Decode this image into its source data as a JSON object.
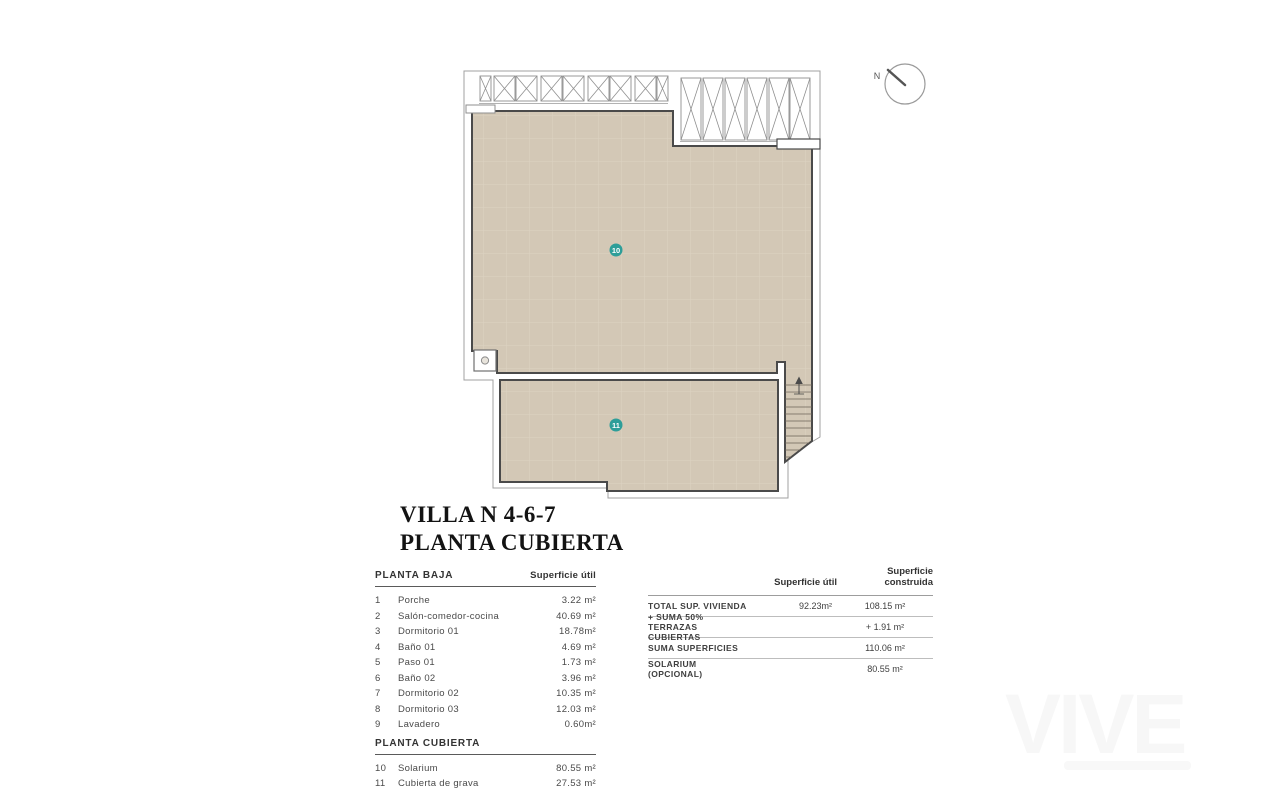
{
  "title": {
    "line1": "VILLA N 4-6-7",
    "line2": "PLANTA CUBIERTA"
  },
  "compass": {
    "label": "N"
  },
  "plan": {
    "room_10_label": "10",
    "room_11_label": "11",
    "floor_fill": "#d3c8b6",
    "accent_teal": "#2d9e99"
  },
  "areas": {
    "section1_title": "PLANTA BAJA",
    "column_title": "Superficie útil",
    "rows": [
      {
        "num": "1",
        "name": "Porche",
        "value": "3.22 m²"
      },
      {
        "num": "2",
        "name": "Salón-comedor-cocina",
        "value": "40.69 m²"
      },
      {
        "num": "3",
        "name": "Dormitorio 01",
        "value": "18.78m²"
      },
      {
        "num": "4",
        "name": "Baño 01",
        "value": "4.69 m²"
      },
      {
        "num": "5",
        "name": "Paso 01",
        "value": "1.73 m²"
      },
      {
        "num": "6",
        "name": "Baño 02",
        "value": "3.96 m²"
      },
      {
        "num": "7",
        "name": "Dormitorio 02",
        "value": "10.35 m²"
      },
      {
        "num": "8",
        "name": "Dormitorio 03",
        "value": "12.03 m²"
      },
      {
        "num": "9",
        "name": "Lavadero",
        "value": "0.60m²"
      }
    ],
    "section2_title": "PLANTA CUBIERTA",
    "rows2": [
      {
        "num": "10",
        "name": "Solarium",
        "value": "80.55 m²"
      },
      {
        "num": "11",
        "name": "Cubierta de grava",
        "value": "27.53 m²"
      }
    ]
  },
  "summary": {
    "col_util": "Superficie útil",
    "col_construida": "Superficie construida",
    "rows": [
      {
        "label": "TOTAL SUP. VIVIENDA",
        "util": "92.23m²",
        "construida": "108.15 m²"
      },
      {
        "label": "+ SUMA 50% TERRAZAS CUBIERTAS",
        "util": "",
        "construida": "+ 1.91 m²"
      },
      {
        "label": "SUMA SUPERFICIES",
        "util": "",
        "construida": "110.06 m²"
      },
      {
        "label": "SOLARIUM (OPCIONAL)",
        "util": "",
        "construida": "80.55 m²"
      }
    ]
  },
  "watermark": {
    "text": "VIVE"
  }
}
